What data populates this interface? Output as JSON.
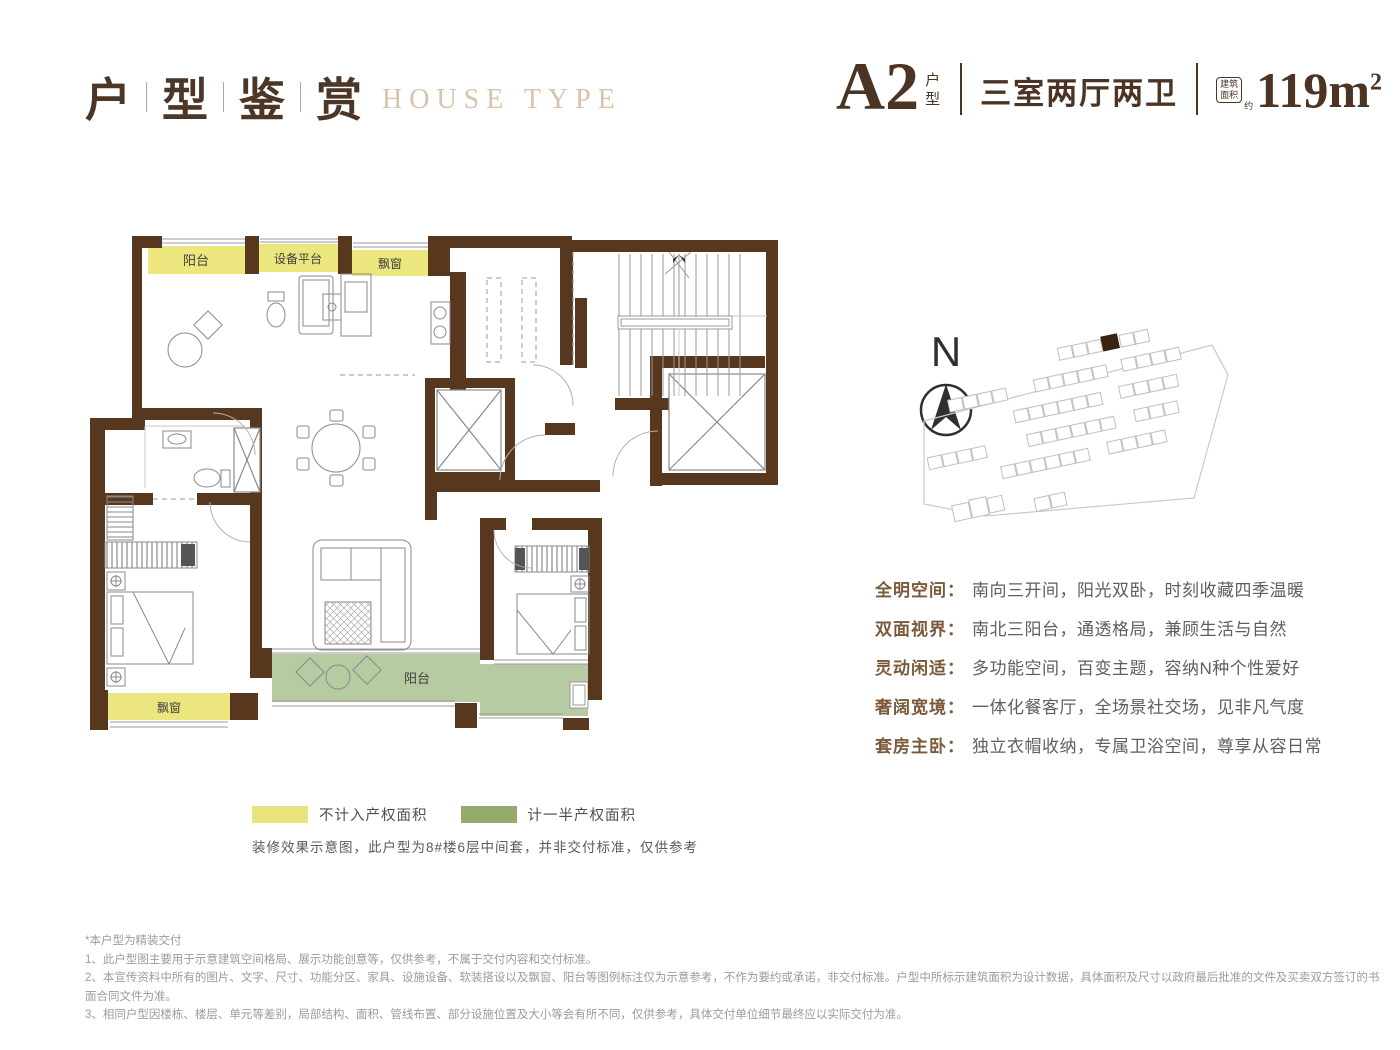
{
  "header": {
    "title_chars": [
      "户",
      "型",
      "鉴",
      "赏"
    ],
    "title_en": "HOUSE TYPE",
    "unit_name": "A2",
    "unit_suffix": "户型",
    "layout": "三室两厅两卫",
    "area_badge": [
      "建筑",
      "面积"
    ],
    "area_approx": "约",
    "area_value": "119m",
    "area_sup": "2"
  },
  "ui": {
    "colon": "："
  },
  "floorplan": {
    "labels": {
      "balcony_top": "阳台",
      "equipment": "设备平台",
      "bay_top": "飘窗",
      "bay_bottom": "飘窗",
      "balcony_bottom": "阳台"
    },
    "colors": {
      "wall": "#57371d",
      "non_property_yellow": "#ece67f",
      "half_property_green": "#b7cba3",
      "thin_line": "#9a9a9a"
    }
  },
  "compass": {
    "north_label": "N"
  },
  "features": [
    {
      "label": "全明空间",
      "text": "南向三开间，阳光双卧，时刻收藏四季温暖"
    },
    {
      "label": "双面视界",
      "text": "南北三阳台，通透格局，兼顾生活与自然"
    },
    {
      "label": "灵动闲适",
      "text": "多功能空间，百变主题，容纳N种个性爱好"
    },
    {
      "label": "奢阔宽境",
      "text": "一体化餐客厅，全场景社交场，见非凡气度"
    },
    {
      "label": "套房主卧",
      "text": "独立衣帽收纳，专属卫浴空间，尊享从容日常"
    }
  ],
  "legend": {
    "items": [
      {
        "label": "不计入产权面积",
        "color": "#e9e37d"
      },
      {
        "label": "计一半产权面积",
        "color": "#94ab6b"
      }
    ],
    "note": "装修效果示意图，此户型为8#楼6层中间套，并非交付标准，仅供参考"
  },
  "disclaimer": [
    "*本户型为精装交付",
    "1、此户型图主要用于示意建筑空间格局、展示功能创意等，仅供参考，不属于交付内容和交付标准。",
    "2、本宣传资料中所有的图片、文字、尺寸、功能分区、家具、设施设备、软装搭设以及飘窗、阳台等图例标注仅为示意参考，不作为要约或承诺，非交付标准。户型中所标示建筑面积为设计数据，具体面积及尺寸以政府最后批准的文件及买卖双方签订的书",
    "面合同文件为准。",
    "3、相同户型因楼栋、楼层、单元等差别，局部结构、面积、管线布置、部分设施位置及大小等会有所不同，仅供参考，具体交付单位细节最终应以实际交付为准。"
  ]
}
